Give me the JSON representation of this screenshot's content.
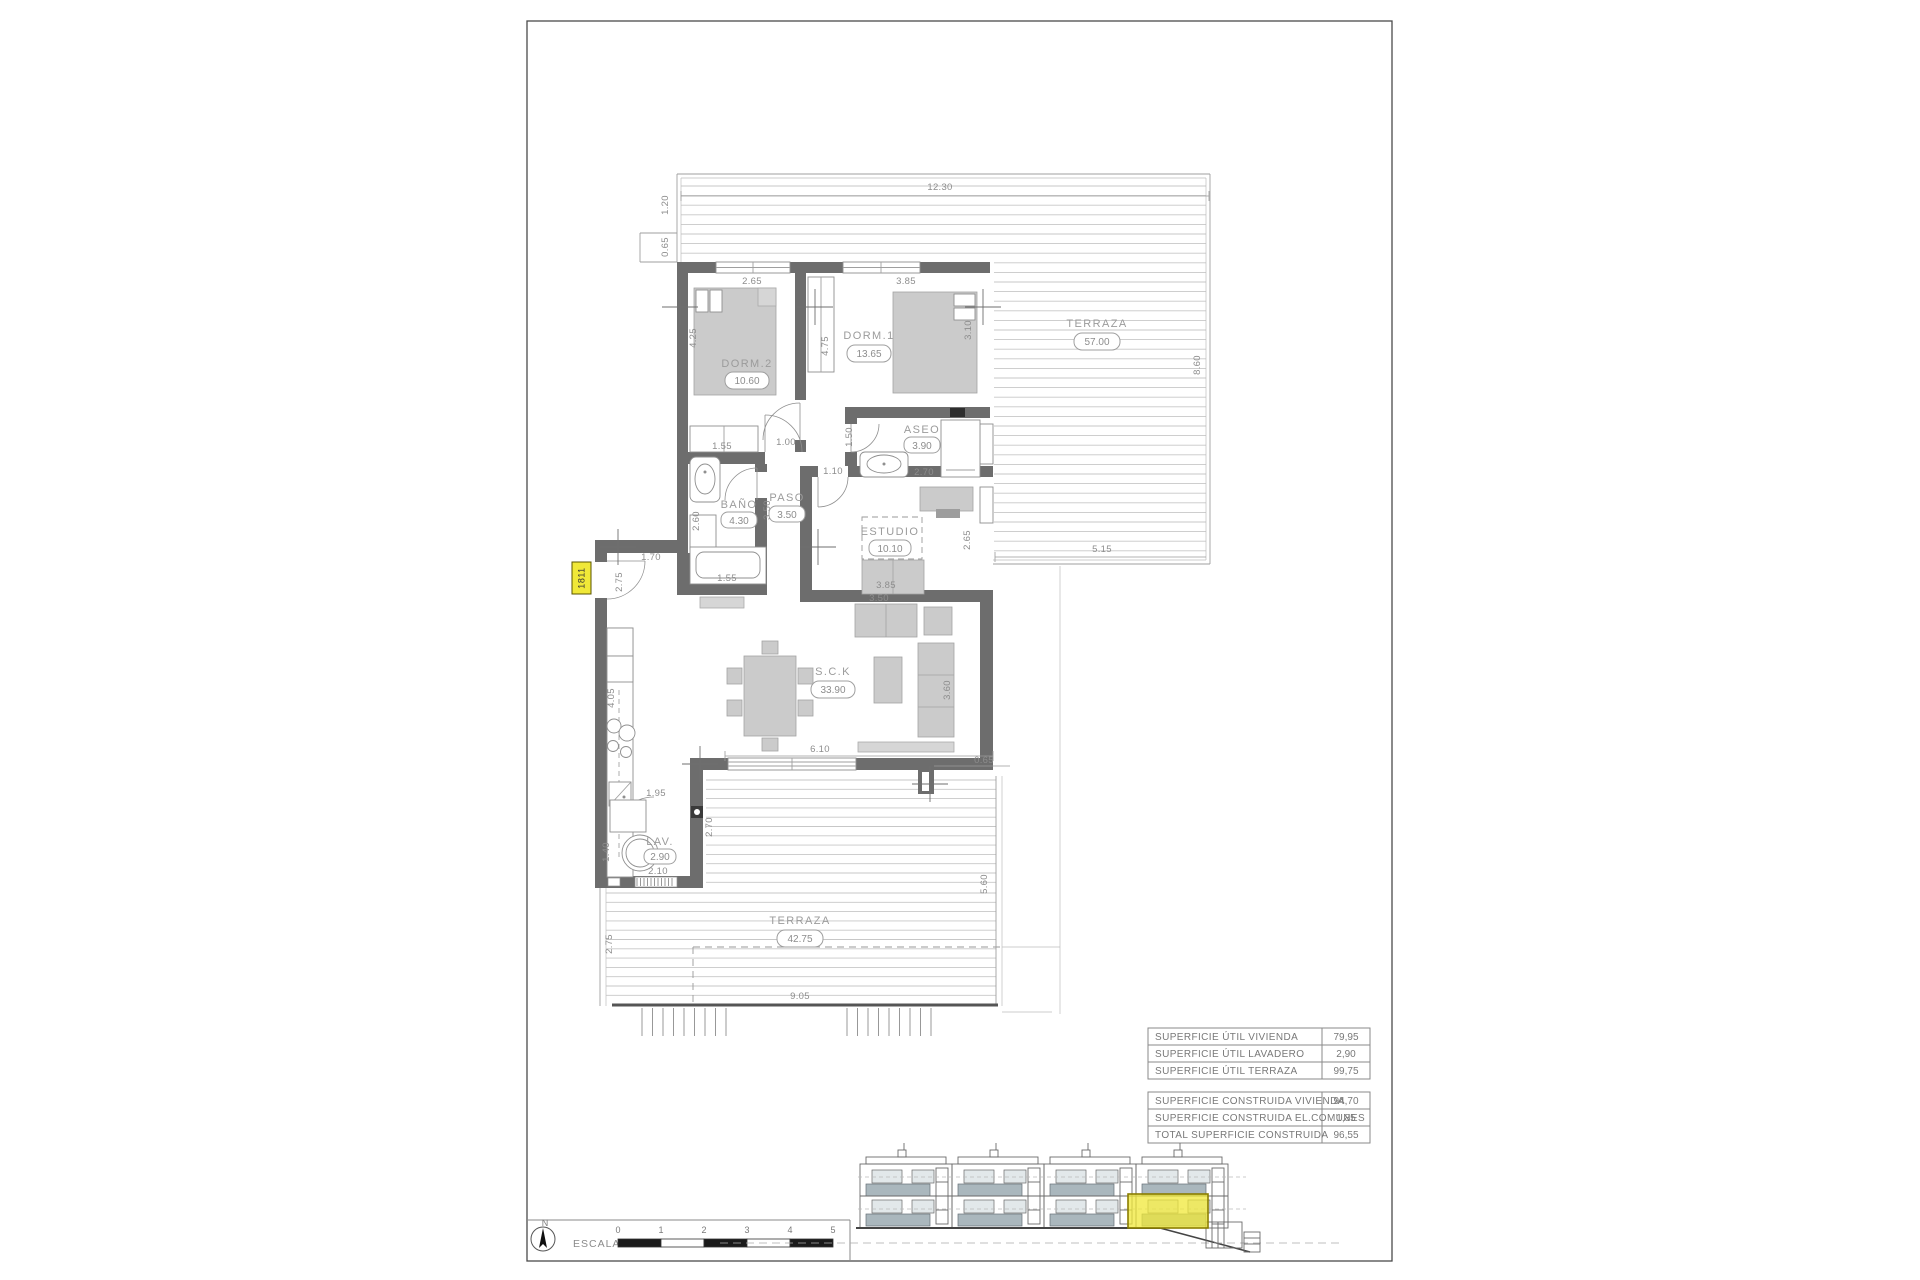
{
  "plan": {
    "unit_tag": "1811",
    "rooms": {
      "terraza_top": {
        "name": "TERRAZA",
        "area": "57.00"
      },
      "dorm2": {
        "name": "DORM.2",
        "area": "10.60"
      },
      "dorm1": {
        "name": "DORM.1",
        "area": "13.65"
      },
      "aseo": {
        "name": "ASEO",
        "area": "3.90"
      },
      "bano": {
        "name": "BAÑO",
        "area": "4.30"
      },
      "paso": {
        "name": "PASO",
        "area": "3.50"
      },
      "estudio": {
        "name": "ESTUDIO",
        "area": "10.10"
      },
      "sck": {
        "name": "S.C.K",
        "area": "33.90"
      },
      "lav": {
        "name": "LAV.",
        "area": "2.90"
      },
      "terraza_bottom": {
        "name": "TERRAZA",
        "area": "42.75"
      }
    },
    "dims": {
      "terrace_top_width": "12.30",
      "terrace_left_upper": "1.20",
      "terrace_left_step": "0.65",
      "dorm2_width": "2.65",
      "dorm1_width": "3.85",
      "dorm2_depth": "4.25",
      "dorm1_wardrobe": "4.75",
      "dorm1_depth": "3.10",
      "terrace_right_depth": "8.60",
      "dorm2_closet": "1.55",
      "paso_top": "1.00",
      "aseo_door": "1.50",
      "aseo_width": "2.70",
      "paso_bottom": "1.10",
      "paso_length": "3.50",
      "bano_width": "2.60",
      "bano_tub": "1.55",
      "terrace_bottom_edge": "5.15",
      "entry_width": "1.70",
      "entry_depth": "2.75",
      "estudio_width": "3.85",
      "estudio_depth": "2.65",
      "sofa_width": "3.50",
      "sofa_depth": "3.60",
      "sck_opening": "6.10",
      "pier_offset": "0.65",
      "kitchen_length": "4.05",
      "lav_top": "1.95",
      "lav_bottom": "2.10",
      "lav_right": "2.70",
      "lav_left": "1.40",
      "terrace2_left": "2.75",
      "terrace2_width": "9.05",
      "terrace2_right": "5.60"
    }
  },
  "summary": {
    "util": [
      {
        "label": "SUPERFICIE ÚTIL VIVIENDA",
        "value": "79,95"
      },
      {
        "label": "SUPERFICIE ÚTIL LAVADERO",
        "value": "2,90"
      },
      {
        "label": "SUPERFICIE ÚTIL TERRAZA",
        "value": "99,75"
      }
    ],
    "built": [
      {
        "label": "SUPERFICIE CONSTRUIDA VIVIENDA",
        "value": "94,70"
      },
      {
        "label": "SUPERFICIE CONSTRUIDA EL.COMUNES",
        "value": "1,85"
      },
      {
        "label": "TOTAL SUPERFICIE CONSTRUIDA",
        "value": "96,55"
      }
    ]
  },
  "scalebar": {
    "north": "N",
    "label": "ESCALA :",
    "ticks": [
      "0",
      "1",
      "2",
      "3",
      "4",
      "5"
    ]
  },
  "colors": {
    "wall": "#6d6d6d",
    "highlight_yellow": "#f0e838"
  }
}
